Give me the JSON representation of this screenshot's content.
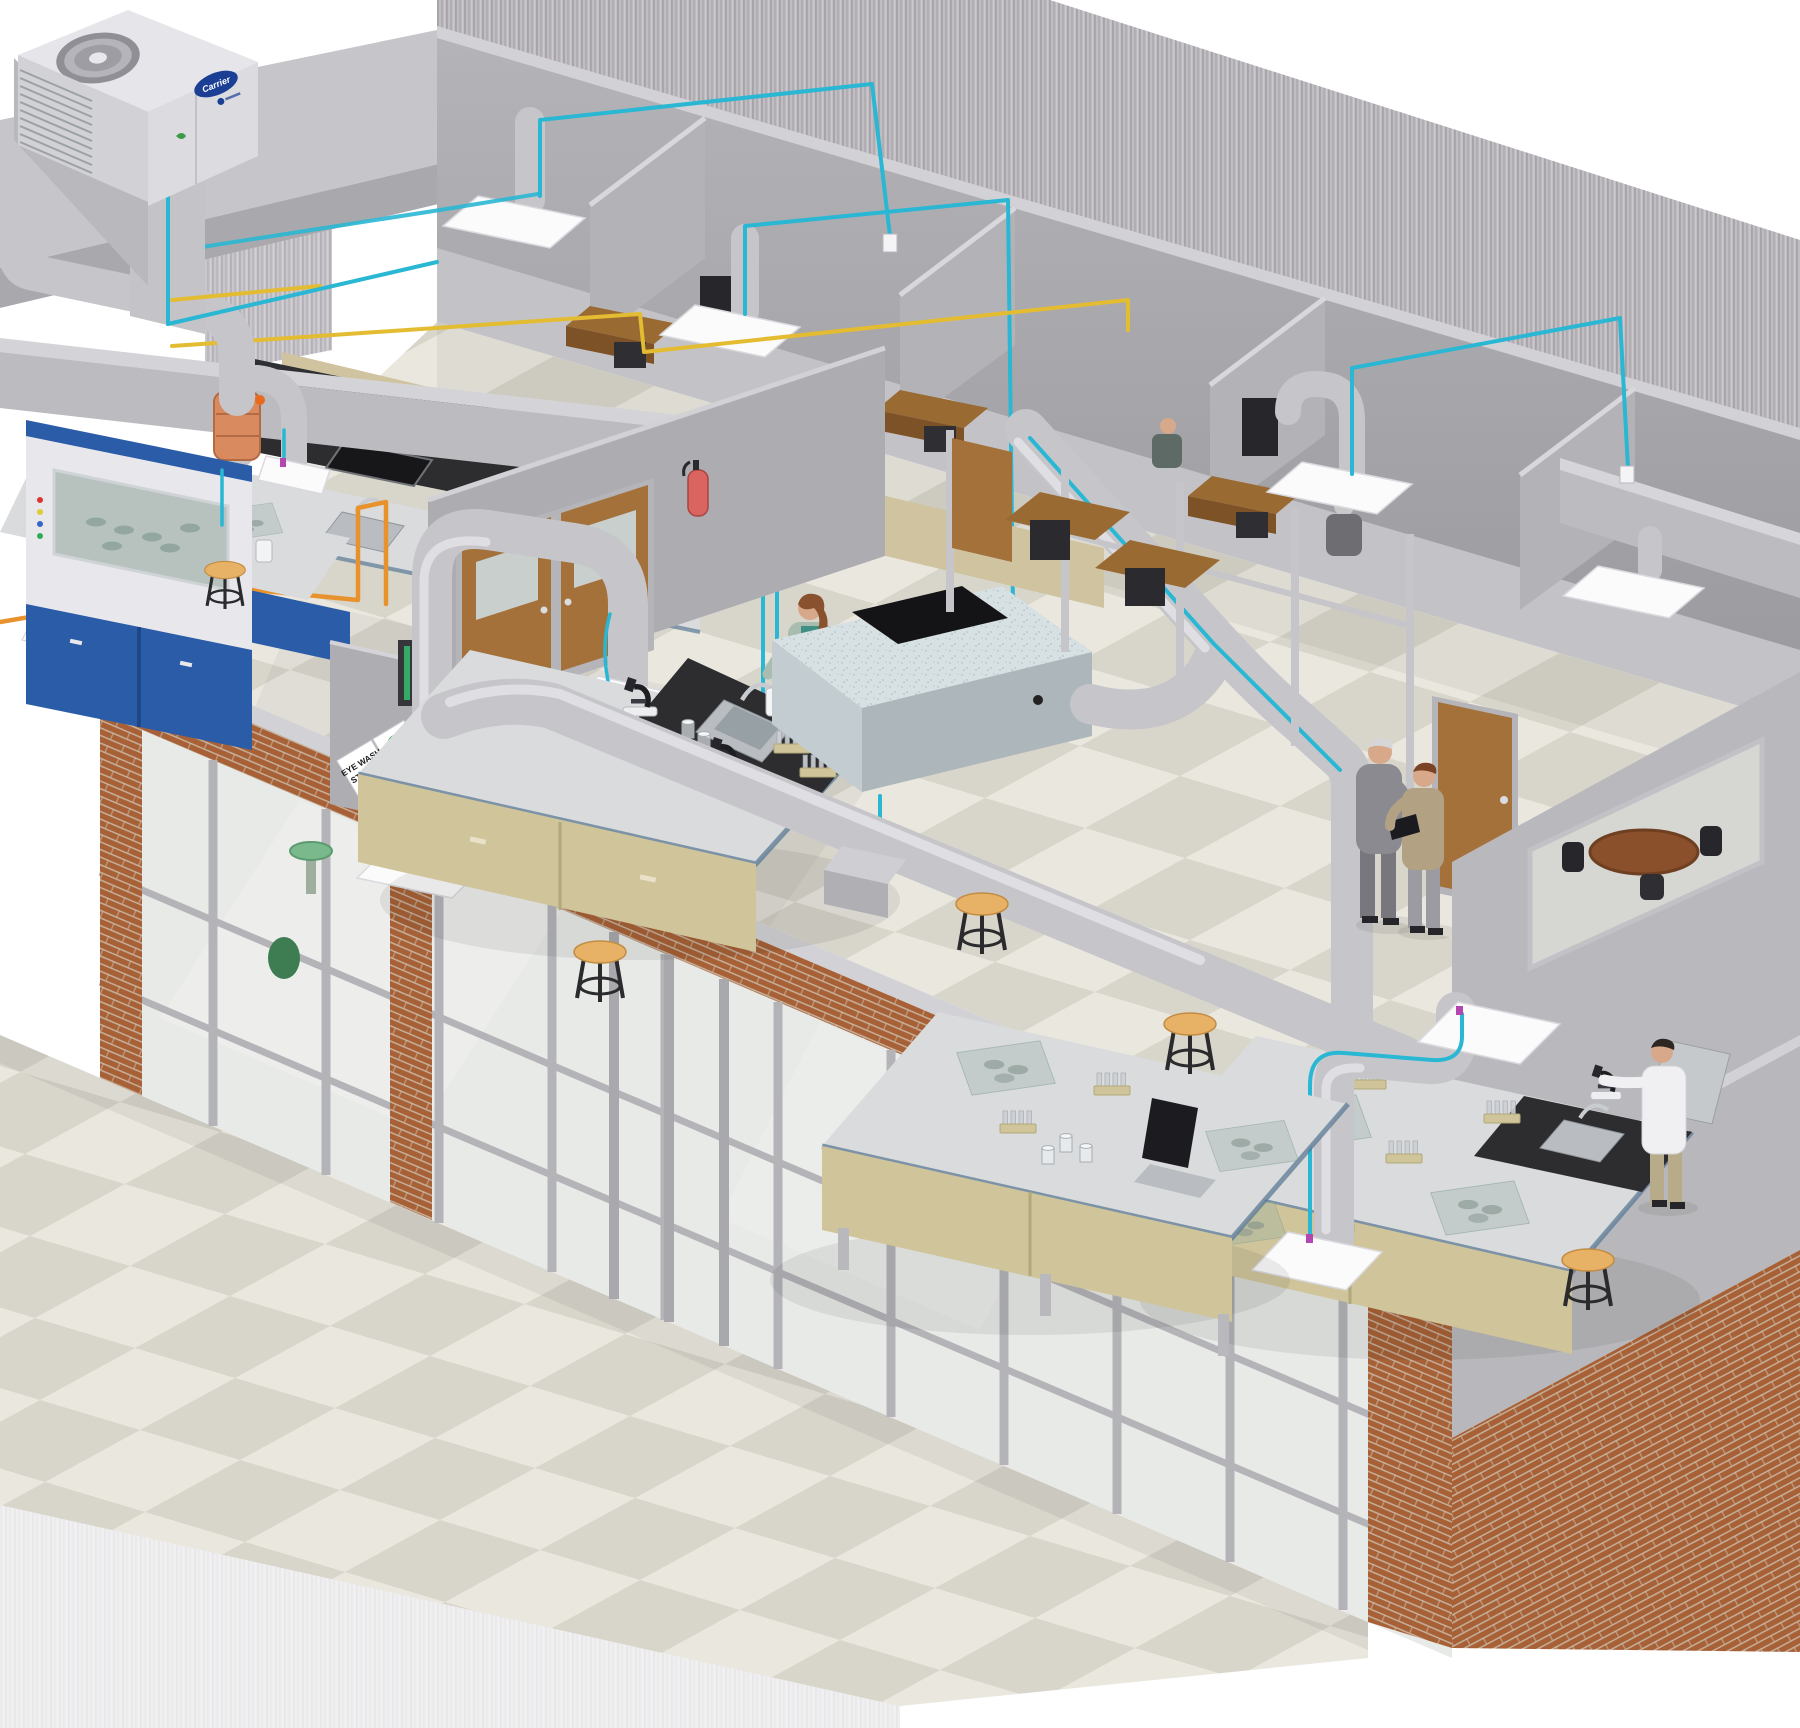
{
  "illustration": {
    "subject": "isometric cutaway of a laboratory building HVAC system",
    "labels": {
      "eye_wash_sign_line1": "EYE WASH",
      "eye_wash_sign_line2": "STATION",
      "rtu_brand": "Carrier"
    },
    "objects": [
      "rooftop-unit",
      "supply-column-duct",
      "fume-hood",
      "fume-hood-exhaust-duct",
      "flex-connector",
      "kitchen-counter-sink",
      "lab-bench-left",
      "lab-bench-center",
      "lab-bench-bottom",
      "lab-bench-right",
      "air-handler-box",
      "door-arch-duct",
      "long-duct-run",
      "diagonal-duct-run",
      "bench-arch-duct",
      "ceiling-diffuser-plates",
      "snorkel-exhaust",
      "control-wiring-cyan",
      "control-wiring-yellow",
      "control-wiring-orange",
      "double-wood-door",
      "fire-extinguisher",
      "eye-wash-sign",
      "eye-wash-basin",
      "conference-table",
      "office-desks",
      "stools",
      "microscopes",
      "test-tube-racks",
      "beakers",
      "petri-trays",
      "laptops",
      "woman-at-sink",
      "suit-man",
      "technician-with-tablet",
      "scientist-lab-coat",
      "office-worker",
      "glass-curtain-wall",
      "brick-pillars",
      "checkered-floor"
    ]
  },
  "palette": {
    "wall": "#a9a9ad",
    "wall-dark": "#97979b",
    "wall-top": "#d2d2d6",
    "wall-mid": "#bcbcc0",
    "corridor": "#c3c3c7",
    "floor-a": "#e9e7de",
    "floor-b": "#d8d6cb",
    "duct": "#c6c6ca",
    "duct-hi": "#ebebef",
    "duct-sh": "#9b9ba1",
    "cyan": "#29b7d3",
    "yellow": "#e3bc31",
    "orange": "#e8922e",
    "sleeve": "#d98a5e",
    "magenta": "#b545b0",
    "bench-top": "#d9dbdc",
    "bench-edge": "#5b7a96",
    "cab-tan": "#cfc49a",
    "cab-tan-hi": "#ded4ad",
    "counter": "#2d2d30",
    "steel": "#b9bcc0",
    "blue-cab": "#2b5ca8",
    "blue-cab-dark": "#1f4687",
    "brick": "#a86136",
    "mortar": "#c9bba8",
    "wood": "#9a6a33",
    "wood-dark": "#7d5227",
    "door-wood": "#a4713b",
    "red": "#d96460",
    "green": "#27a147",
    "basin-green": "#79b98c",
    "skin": "#d8a88a",
    "hair-auburn": "#8a512f",
    "teal": "#3f9082",
    "sage": "#a9bcb0",
    "suit": "#8a8a90",
    "khaki": "#b3a183",
    "coat": "#f0f0f2",
    "navy": "#1b3f94",
    "stool": "#e8b266",
    "ahu": "#d7e0e3",
    "glass": "#e8eae7"
  }
}
